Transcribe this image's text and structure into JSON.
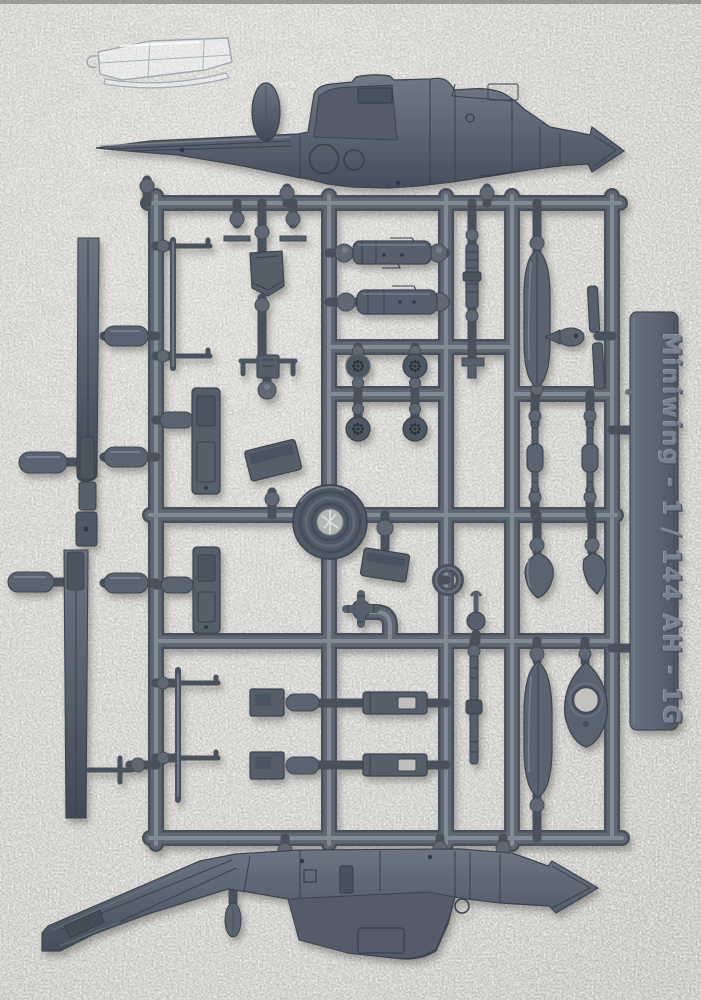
{
  "photo": {
    "subject": "injection-molded model kit sprue on white foam",
    "kit": {
      "brand": "Miniwing",
      "scale": "1 / 144",
      "model": "AH - 1G"
    },
    "label_text": "Miniwing  -  1 / 144   AH - 1G",
    "colors": {
      "sprue": "#5d6772",
      "sprue_highlight": "#8d96a1",
      "sprue_shadow": "#434c57",
      "foam": "#c7c6c2",
      "clear_part": "#eef2f5",
      "label_emboss": "#78828e"
    },
    "parts": [
      {
        "name": "fuselage-right-half",
        "count": 1
      },
      {
        "name": "fuselage-left-half",
        "count": 1
      },
      {
        "name": "clear-canopy",
        "count": 1
      },
      {
        "name": "main-rotor-blade",
        "count": 2
      },
      {
        "name": "tail-rotor",
        "count": 1
      },
      {
        "name": "rocket-pod",
        "count": 5
      },
      {
        "name": "landing-skid",
        "count": 2
      },
      {
        "name": "engine-block",
        "count": 2
      },
      {
        "name": "minigun-barrel",
        "count": 2
      },
      {
        "name": "gun-barrel",
        "count": 2
      },
      {
        "name": "wheel-disc",
        "count": 4
      },
      {
        "name": "rotor-head-disc",
        "count": 1
      },
      {
        "name": "pilot-seat",
        "count": 2
      },
      {
        "name": "intake-scoop",
        "count": 2
      },
      {
        "name": "instrument-panel",
        "count": 1
      },
      {
        "name": "rotor-hub-cross",
        "count": 1
      },
      {
        "name": "exhaust-ring",
        "count": 1
      },
      {
        "name": "ammo-bay-door",
        "count": 2
      },
      {
        "name": "ammo-box",
        "count": 2
      },
      {
        "name": "mount-plate",
        "count": 2
      },
      {
        "name": "fuel-pod",
        "count": 2
      },
      {
        "name": "fin-tip-fairing",
        "count": 1
      },
      {
        "name": "nose-cone",
        "count": 2
      },
      {
        "name": "sway-brace",
        "count": 1
      },
      {
        "name": "antenna-blade",
        "count": 1
      },
      {
        "name": "small-fitting",
        "count": 2
      }
    ]
  }
}
